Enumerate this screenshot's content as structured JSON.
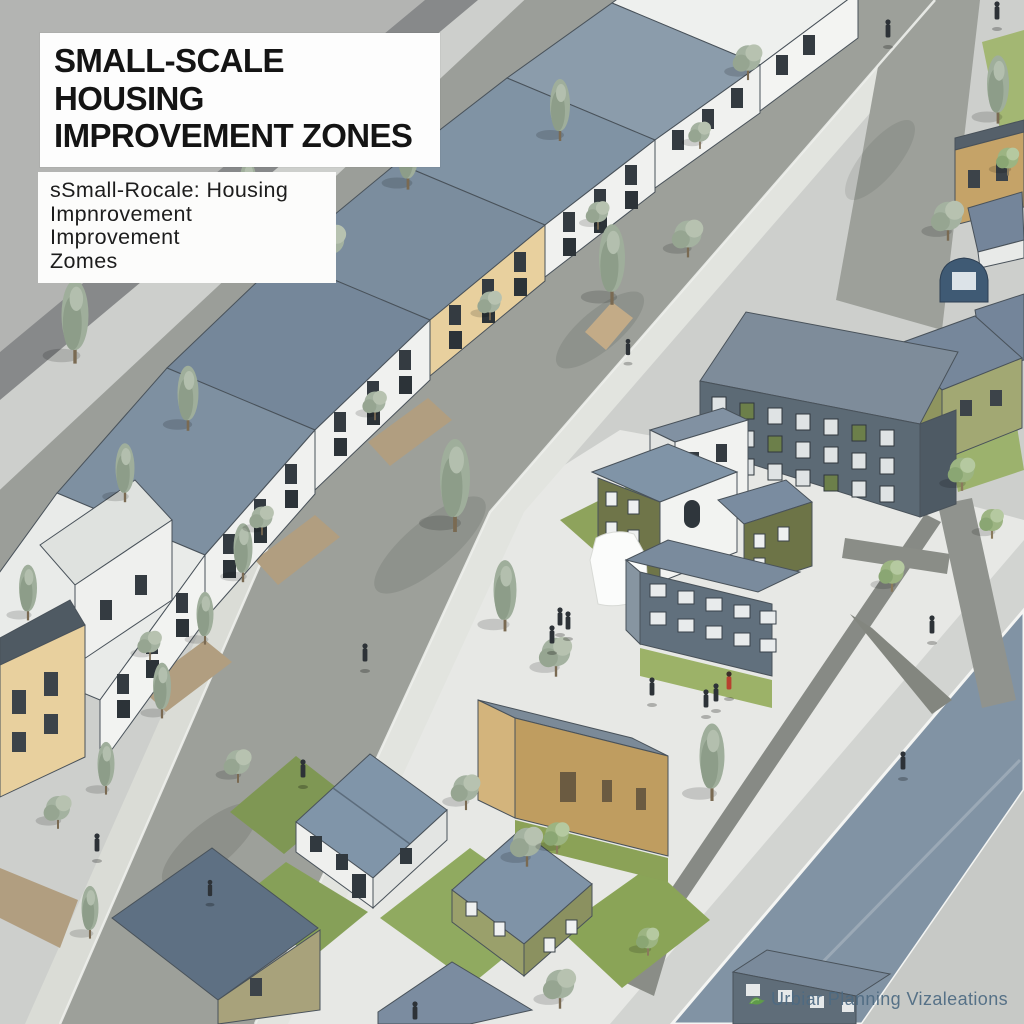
{
  "poster": {
    "title": {
      "line1": "SMALL-SCALE HOUSING",
      "line2": "IMPROVEMENT ZONES"
    },
    "caption": {
      "line1": "sSmall-Rocale: Housing",
      "line2": "Impnrovement Improvement",
      "line3": "Zomes"
    },
    "watermark": "Urbiar Planning Vizaleations"
  },
  "colors": {
    "background": "#cdcfcc",
    "corner_gray": "#b3b4b2",
    "dark_band": "#87898a",
    "road": "#9da09a",
    "road_blue": "#8193a4",
    "plaza": "#e7e8e5",
    "roof_slate": "#7b8da0",
    "wall_white": "#f0f1ef",
    "wall_yellow": "#e8d09e",
    "wall_olive": "#6f7549",
    "wall_tan": "#c5a368",
    "apartment_dark": "#5c6a75",
    "lawn": "#8aa457",
    "tree_sage": "#a4b2a0",
    "watermark_text": "#4d6a82"
  }
}
